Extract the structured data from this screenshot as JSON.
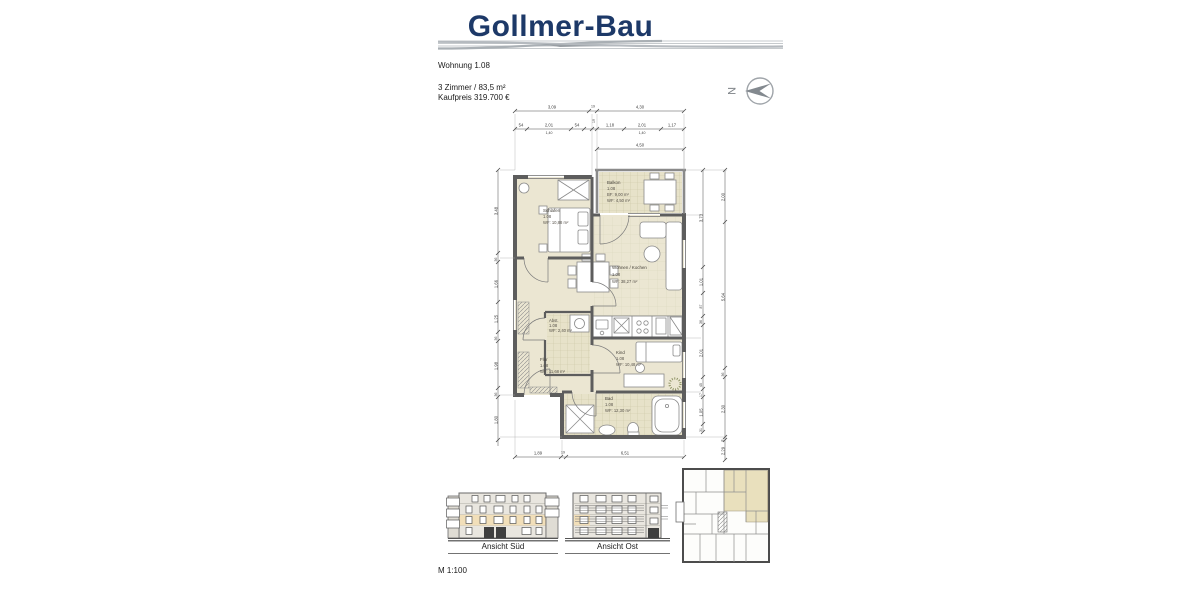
{
  "header": {
    "brand": "Gollmer-Bau",
    "unit": "Wohnung 1.08",
    "rooms_line": "3 Zimmer  /  83,5 m²",
    "price_line": "Kaufpreis 319.700 €",
    "north": "N"
  },
  "rooms": {
    "schlafen": {
      "name": "Schlafen",
      "nr": "1.08",
      "area": "WF: 10,88 m²"
    },
    "balkon": {
      "name": "Balkon",
      "nr": "1.08",
      "bf": "BF: 9,00 m²",
      "wf": "WF: 4,50 m²"
    },
    "wohnen": {
      "name": "Wohnen / Kochen",
      "nr": "1.08",
      "area": "WF:    38,27 m²"
    },
    "abstell": {
      "name": "Abst.",
      "nr": "1.08",
      "area": "WF: 2,40 m²"
    },
    "flur": {
      "name": "Flur",
      "nr": "1.08",
      "area": "WF: 11,68 m²"
    },
    "kind": {
      "name": "Kind",
      "nr": "1.08",
      "area": "WF: 10,48 m²"
    },
    "bad": {
      "name": "Bad",
      "nr": "1.08",
      "area": "WF: 12,30 m²"
    }
  },
  "dims": {
    "top1": [
      "3,09",
      "19",
      "4,30"
    ],
    "top2": [
      "54",
      "2,01",
      "1,40",
      "54",
      "19",
      "1,18",
      "2,01",
      "1,40",
      "1,17"
    ],
    "top3": [
      "4,50"
    ],
    "left": [
      "3,48",
      "36",
      "1,66",
      "1,25",
      "36",
      "1,98",
      "36",
      "1,80"
    ],
    "right_inner": [
      "3,73",
      "1,01",
      "87",
      "36",
      "2,01",
      "45",
      "17",
      "1,05",
      "31"
    ],
    "right_outer": [
      "2,00",
      "5,64",
      "36",
      "2,30",
      "8",
      "2,29"
    ],
    "bottom": [
      "1,89",
      "19",
      "6,51"
    ]
  },
  "footer": {
    "ansicht_sued": "Ansicht Süd",
    "ansicht_ost": "Ansicht Ost",
    "scale": "M 1:100"
  },
  "colors": {
    "brand_blue": "#1d3968",
    "room_beige": "#ebe6d2",
    "highlight": "#f2dfb9",
    "wall_gray": "#5d5d5d"
  }
}
